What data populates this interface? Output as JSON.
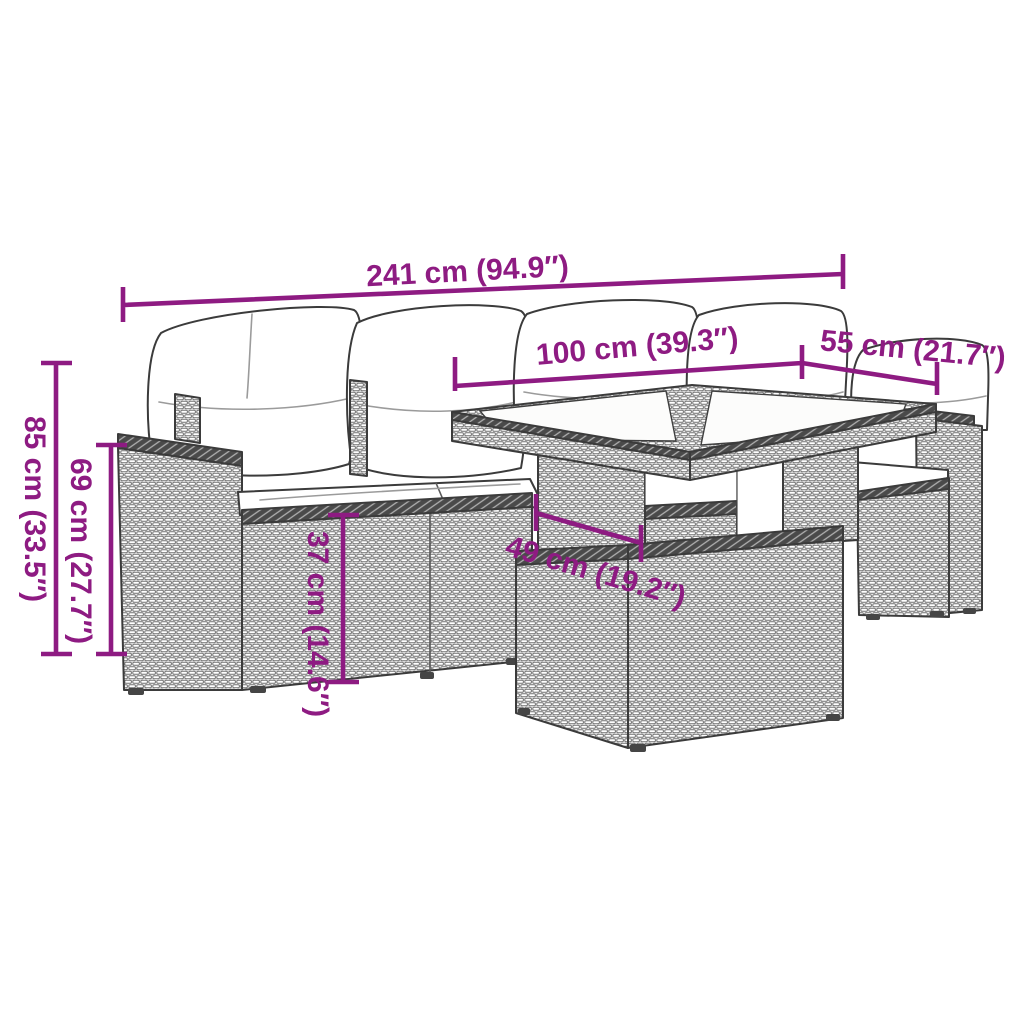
{
  "colors": {
    "accent": "#8e1b82",
    "furniture_outline": "#3b3b3b",
    "cushion_fill": "#ffffff",
    "background": "#ffffff"
  },
  "diagram": {
    "kind": "furniture-dimension-line-drawing",
    "dimensions": {
      "overall_width": {
        "label": "241 cm (94.9″)"
      },
      "table_length": {
        "label": "100 cm (39.3″)"
      },
      "table_depth": {
        "label": "55 cm (21.7″)"
      },
      "total_height": {
        "label": "85 cm (33.5″)"
      },
      "arm_height": {
        "label": "69 cm (27.7″)"
      },
      "seat_height": {
        "label": "37 cm (14.6″)"
      },
      "stool_depth": {
        "label": "49 cm (19.2″)"
      }
    }
  }
}
